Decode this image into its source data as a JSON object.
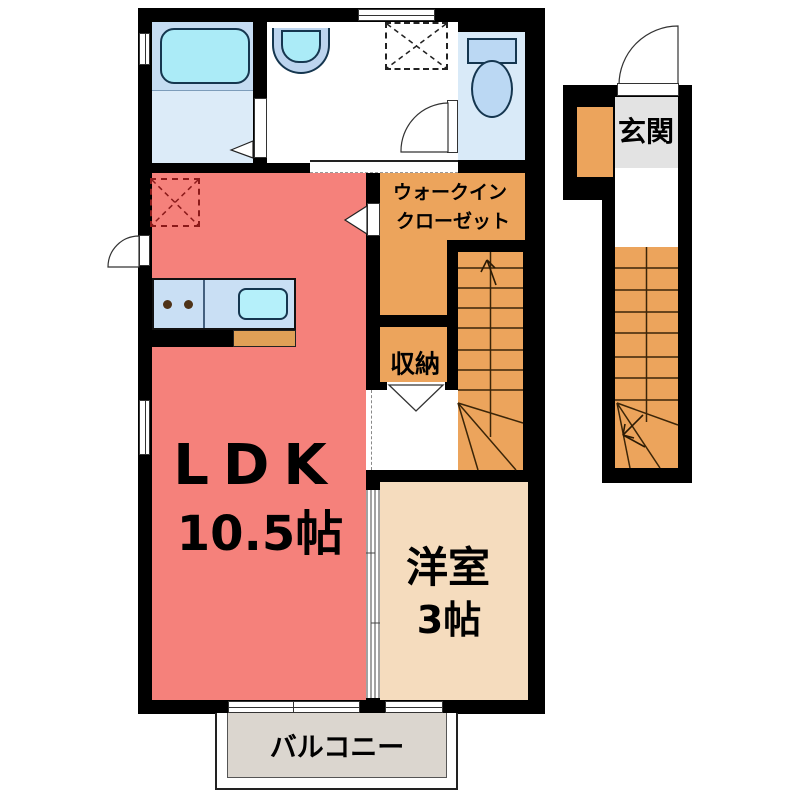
{
  "title": "apartment floor plan",
  "rooms": {
    "ldk": {
      "label": "LDK",
      "area": "10.5帖"
    },
    "western_room": {
      "label": "洋室",
      "area": "3帖"
    },
    "walk_in_closet": {
      "line1": "ウォークイン",
      "line2": "クローゼット"
    },
    "storage": {
      "label": "収納"
    },
    "entrance": {
      "label": "玄関"
    },
    "balcony": {
      "label": "バルコニー"
    }
  },
  "fixtures": {
    "bathtub": "bathtub",
    "washbasin": "washbasin",
    "toilet": "toilet",
    "kitchen_counter": "kitchen counter with sink and 2 burners",
    "washing_machine_space": "dashed square with X (washer space)",
    "refrigerator_space": "dashed square with X (fridge space)",
    "stairs_interior": "staircase 2F (arrow up)",
    "stairs_entrance": "staircase 1F entrance (arrow up)"
  },
  "colors": {
    "wall": "#000000",
    "ldk": "#F5817B",
    "orange_rooms": "#ECA45C",
    "western_room": "#F5DCBE",
    "bath_floor": "#C5DCF2",
    "bath_floor_lower": "#DCEBF8",
    "tub": "#ABEBF7",
    "toilet_room": "#D9EAF8",
    "toilet_fixture": "#BBD8F3",
    "counter": "#C9DFF4",
    "sink": "#B5F0FA",
    "counter_front": "#DFA057",
    "genkan_gray": "#E3E3E3",
    "balcony_gray": "#DBD6CF",
    "fridge_dash": "#8B1A1A",
    "stair_line": "#3B2508"
  }
}
